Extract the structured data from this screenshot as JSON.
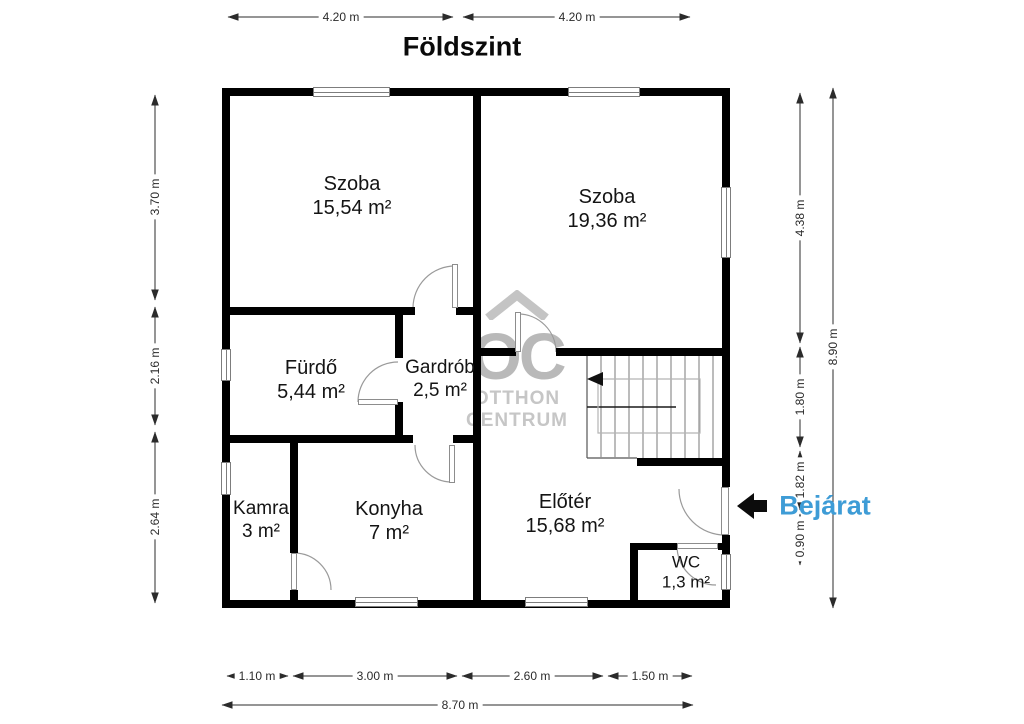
{
  "title": "Földszint",
  "watermark": {
    "logo": "OC",
    "line1": "OTTHON",
    "line2": "CENTRUM"
  },
  "entrance": {
    "label": "Bejárat"
  },
  "rooms": [
    {
      "name": "Szoba",
      "area": "15,54 m²"
    },
    {
      "name": "Szoba",
      "area": "19,36 m²"
    },
    {
      "name": "Fürdő",
      "area": "5,44 m²"
    },
    {
      "name": "Gardrób",
      "area": "2,5 m²"
    },
    {
      "name": "Kamra",
      "area": "3 m²"
    },
    {
      "name": "Konyha",
      "area": "7 m²"
    },
    {
      "name": "Előtér",
      "area": "15,68 m²"
    },
    {
      "name": "WC",
      "area": "1,3 m²"
    }
  ],
  "dimensions": {
    "top": [
      "4.20 m",
      "4.20 m"
    ],
    "left": [
      "3.70 m",
      "2.16 m",
      "2.64 m"
    ],
    "right": [
      "4.38 m",
      "1.80 m",
      "1.82 m",
      "0.90 m"
    ],
    "right_total": "8.90 m",
    "bottom": [
      "1.10 m",
      "3.00 m",
      "2.60 m",
      "1.50 m"
    ],
    "bottom_total": "8.70 m"
  },
  "colors": {
    "wall": "#000000",
    "entrance_text": "#3e9cd6",
    "watermark": "#c0c0c0",
    "dimension_line": "#2b2b2b",
    "door_line": "#9a9a9a"
  }
}
